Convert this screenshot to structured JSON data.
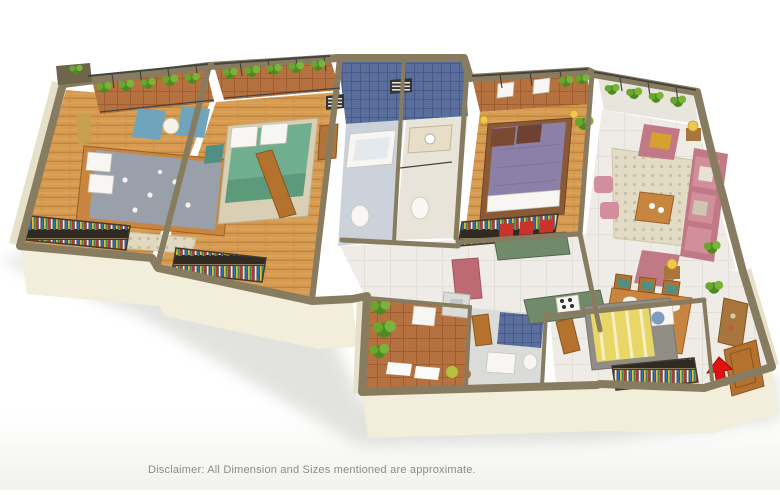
{
  "disclaimer": "Disclaimer: All Dimension and Sizes mentioned are approximate.",
  "scene": {
    "type": "3d-isometric-floor-plan",
    "view": "cutaway apartment render on white background, entry arrow at lower right",
    "rooms": [
      {
        "name": "bedroom-1",
        "floor": "wood",
        "items": [
          "double bed with grey floral duvet",
          "wood frame",
          "foot bench",
          "two blue armchairs",
          "round table",
          "wall art",
          "open wardrobe with clothes",
          "balcony with planters"
        ]
      },
      {
        "name": "bedroom-2",
        "floor": "wood",
        "items": [
          "double bed with green duvet",
          "open wardrobe with clothes",
          "dresser",
          "balcony with planters"
        ]
      },
      {
        "name": "bathroom-1",
        "floor": "tile",
        "items": [
          "bathtub",
          "toilet",
          "blue tiled wall",
          "louver vent"
        ]
      },
      {
        "name": "bathroom-2",
        "floor": "tile",
        "items": [
          "vanity counter",
          "toilet",
          "blue tiled wall",
          "louver vent"
        ]
      },
      {
        "name": "master-bedroom",
        "floor": "wood",
        "items": [
          "double bed with purple duvet and brown pillows",
          "bedside lamps",
          "open wardrobe with clothes",
          "balcony with two white chairs",
          "plant"
        ]
      },
      {
        "name": "living-room",
        "floor": "marble",
        "items": [
          "pink three-seat sofa",
          "pink armchair",
          "pink loveseat",
          "two pink ottomans",
          "patterned rug",
          "wood coffee table",
          "side tables with yellow lamps",
          "plants",
          "balcony with planters"
        ]
      },
      {
        "name": "kitchen",
        "floor": "marble",
        "items": [
          "green granite breakfast bar",
          "three red bar stools",
          "green L-counter with gas stove",
          "pink island block",
          "sink unit"
        ]
      },
      {
        "name": "dining-room",
        "floor": "marble",
        "items": [
          "wood dining table with six place settings",
          "six wood chairs with teal seats",
          "console sideboard",
          "plants"
        ]
      },
      {
        "name": "foyer",
        "floor": "marble",
        "items": [
          "open wooden main door",
          "red entry arrow"
        ]
      },
      {
        "name": "bedroom-3",
        "floor": "marble",
        "items": [
          "bed with yellow striped blanket and grey frame",
          "white and blue pillows",
          "open wardrobe with clothes"
        ]
      },
      {
        "name": "utility-balcony",
        "floor": "terracotta",
        "items": [
          "potted plants",
          "wash sink",
          "white mats",
          "green stool",
          "wood stool"
        ]
      },
      {
        "name": "bathroom-3",
        "floor": "tile",
        "items": [
          "wash basin",
          "toilet",
          "blue tiled wall",
          "wood door"
        ]
      }
    ]
  },
  "icons": {
    "entry_arrow": "red-entry-arrow"
  },
  "palette": {
    "wallTop": "#877c60",
    "wallTopDark": "#6f654c",
    "wallFace": "#f2eedb",
    "wallFaceDim": "#e7e1cb",
    "wood": "#d79b52",
    "marble": "#efece7",
    "terracotta": "#b5713f",
    "tileBlue": "#5b6f9d",
    "bathFloor": "#ccd2da",
    "clothesDark": "#2f2a22",
    "sofaPink": "#c07985",
    "sofaPinkLight": "#d08f9a",
    "bedGrey": "#9aa0aa",
    "bedGreen": "#6fae8e",
    "bedPurple": "#8d80a8",
    "bedYellow": "#e8d667",
    "counterGreen": "#708a6a",
    "stoolRed": "#c8342a",
    "doorWood": "#b5722f",
    "woodFurniture": "#c8853f",
    "chairBlue": "#6fa5bc",
    "seatTeal": "#4f8f84",
    "lampYellow": "#eec84f",
    "plantDark": "#4e8a22",
    "plantLight": "#7ab33a",
    "arrowRed": "#e01210",
    "disclaimerText": "#8b8b8b",
    "background": "#ffffff"
  }
}
